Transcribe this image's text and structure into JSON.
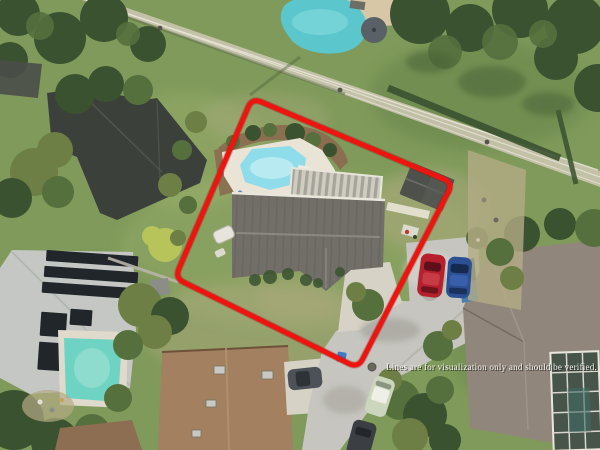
{
  "scene": {
    "type": "aerial-property-photo",
    "description": "Overhead drone view of a suburban lot outlined in red, with swimming pools, gray and brown roofs, driveways, parked cars and a powerline corridor",
    "disclaimer": "Lines are for visualization only and should be verified."
  },
  "colors": {
    "grass": "#7f9a5a",
    "grassLight": "#a6b673",
    "grassDark": "#617e46",
    "grassPale": "#b3ab85",
    "treeDark": "#3a5230",
    "treeMid": "#55703d",
    "treeOlive": "#6d7f44",
    "treeBright": "#b6c45a",
    "corridor": "#cfc8b4",
    "wire": "#e9e5da",
    "roofDark": "#3c403b",
    "roofSubject": "#716f68",
    "roofLight": "#c4c7c3",
    "roofBrown": "#a28060",
    "roofBrown2": "#8d6e52",
    "roofTaupe": "#90867b",
    "shed": "#4e514b",
    "solar": "#20262a",
    "deck": "#e9e4d6",
    "mulch": "#8a6b4f",
    "poolSubject": "#8fdcea",
    "poolTop": "#5cc6cd",
    "poolLeft": "#6fd3c4",
    "pavement": "#c6c5bf",
    "driveway": "#d6d2c6",
    "boundaryRed": "#ee1510",
    "carRed": "#b5202c",
    "carBlue": "#2c4f93",
    "carGray": "#4d5258",
    "carWhite": "#ccd6bd",
    "carDark": "#3b3f43",
    "enclosureDark": "#46544a",
    "textWhite": "#f7f5f1"
  }
}
